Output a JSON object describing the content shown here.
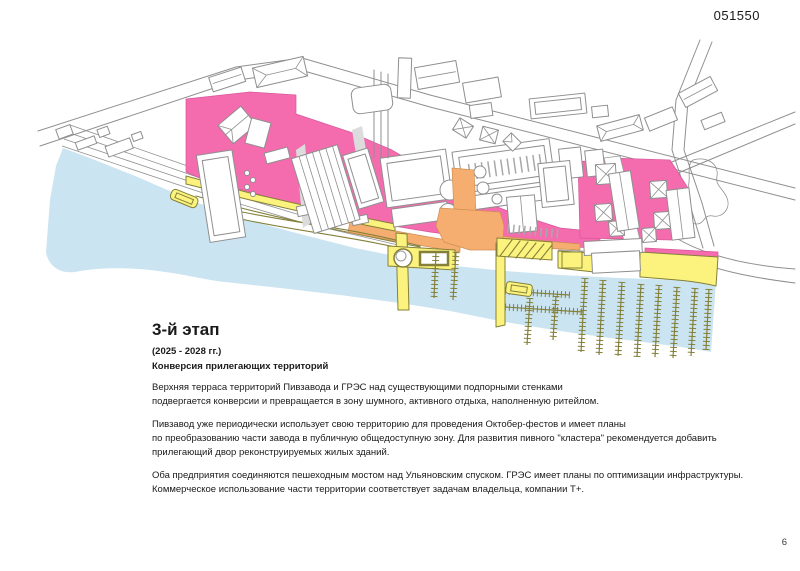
{
  "document": {
    "code": "051550",
    "page_number": "6"
  },
  "stage": {
    "title": "3-й этап",
    "period": "(2025 - 2028 гг.)",
    "subtitle": "Конверсия прилегающих территорий"
  },
  "paragraphs": [
    "Верхняя терраса территорий Пивзавода и ГРЭС над существующими подпорными стенками\nподвергается конверсии и превращается в зону шумного, активного отдыха, наполненную ритейлом.",
    "Пивзавод уже периодически использует свою территорию для проведения Октобер-фестов и имеет планы\nпо преобразованию части завода в публичную общедоступную зону. Для развития пивного \"кластера\" рекомендуется добавить\nприлегающий двор реконструируемых жилых зданий.",
    "Оба предприятия соединяются пешеходным мостом над Ульяновским спуском. ГРЭС имеет планы по оптимизации инфраструктуры.\nКоммерческое использование части территории соответствует задачам владельца, компании Т+."
  ],
  "map": {
    "colors": {
      "water": "#cbe4f1",
      "pink": "#f46cae",
      "yellow": "#fbf37d",
      "orange": "#f5ae6f",
      "olive": "#84803a",
      "line": "#8f8f8f",
      "text": "#1a1a1a"
    }
  }
}
